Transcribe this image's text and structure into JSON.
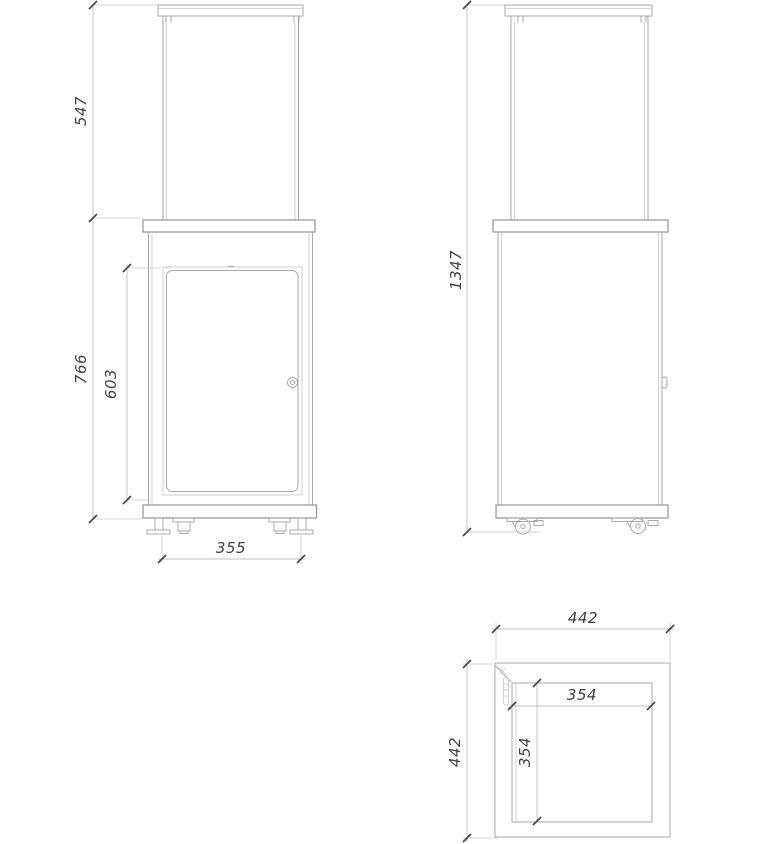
{
  "drawing": {
    "type": "technical-orthographic-drawing",
    "subject": "patio heater cabinet with glass top section, front / side / top views"
  },
  "views": {
    "front": {
      "dimensions": {
        "glass_height": "547",
        "cabinet_height": "766",
        "door_height": "603",
        "base_width": "355"
      }
    },
    "side": {
      "dimensions": {
        "total_height": "1347"
      }
    },
    "top": {
      "dimensions": {
        "outer_width": "442",
        "outer_depth": "442",
        "inner_width": "354",
        "inner_depth": "354"
      }
    }
  },
  "colors": {
    "background": "#ffffff",
    "object_line": "#a9a9a9",
    "light_line": "#c7c7c7",
    "dimension_line": "#c0c0c0",
    "tick": "#4a4a4a",
    "text": "#3f3f3f"
  }
}
